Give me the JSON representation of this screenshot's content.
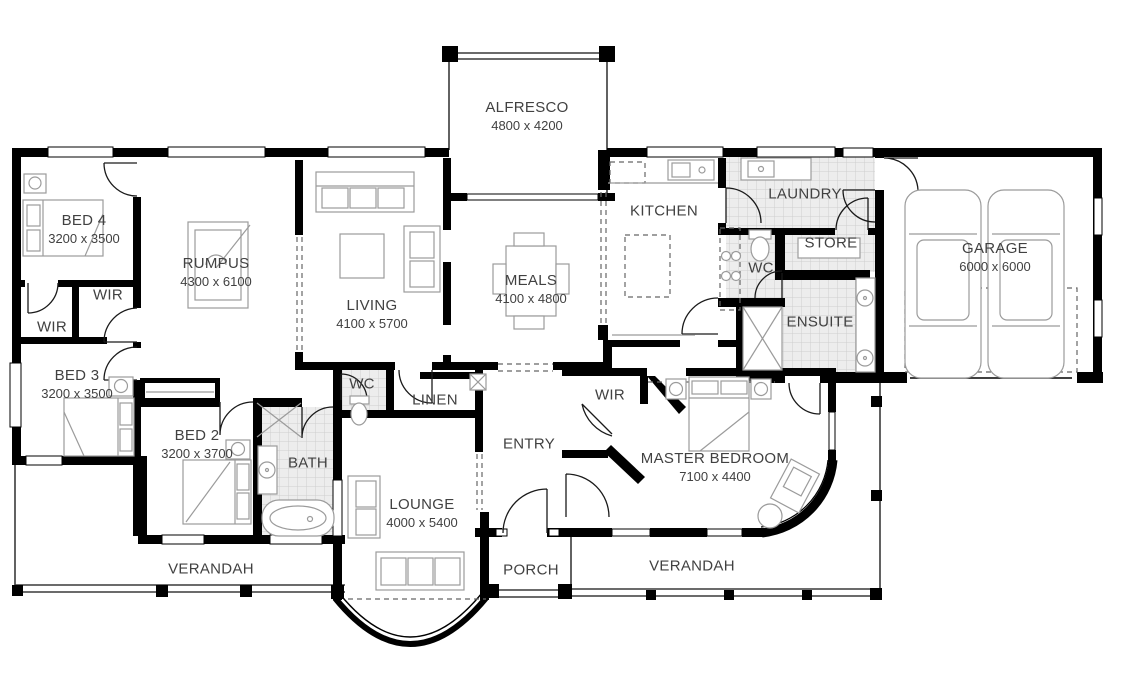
{
  "rooms": {
    "alfresco": {
      "name": "ALFRESCO",
      "dims": "4800 x 4200"
    },
    "bed4": {
      "name": "BED 4",
      "dims": "3200 x 3500"
    },
    "rumpus": {
      "name": "RUMPUS",
      "dims": "4300 x 6100"
    },
    "living": {
      "name": "LIVING",
      "dims": "4100 x 5700"
    },
    "meals": {
      "name": "MEALS",
      "dims": "4100 x 4800"
    },
    "kitchen": {
      "name": "KITCHEN"
    },
    "laundry": {
      "name": "LAUNDRY"
    },
    "store": {
      "name": "STORE"
    },
    "wc_upper": {
      "name": "WC"
    },
    "ensuite": {
      "name": "ENSUITE"
    },
    "garage": {
      "name": "GARAGE",
      "dims": "6000 x 6000"
    },
    "wir_upper": {
      "name": "WIR"
    },
    "wir_lower": {
      "name": "WIR"
    },
    "bed3": {
      "name": "BED 3",
      "dims": "3200 x 3500"
    },
    "bed2": {
      "name": "BED 2",
      "dims": "3200 x 3700"
    },
    "bath": {
      "name": "BATH"
    },
    "wc_lower": {
      "name": "WC"
    },
    "linen": {
      "name": "LINEN"
    },
    "entry": {
      "name": "ENTRY"
    },
    "lounge": {
      "name": "LOUNGE",
      "dims": "4000 x 5400"
    },
    "porch": {
      "name": "PORCH"
    },
    "master": {
      "name": "MASTER BEDROOM",
      "dims": "7100 x 4400"
    },
    "wir_master": {
      "name": "WIR"
    },
    "verandah_left": {
      "name": "VERANDAH"
    },
    "verandah_right": {
      "name": "VERANDAH"
    }
  },
  "colors": {
    "wall": "#000000",
    "furniture": "#9b9b9b",
    "tile_bg": "#ededed",
    "tile_line": "#cfcfcf",
    "text": "#414141"
  }
}
